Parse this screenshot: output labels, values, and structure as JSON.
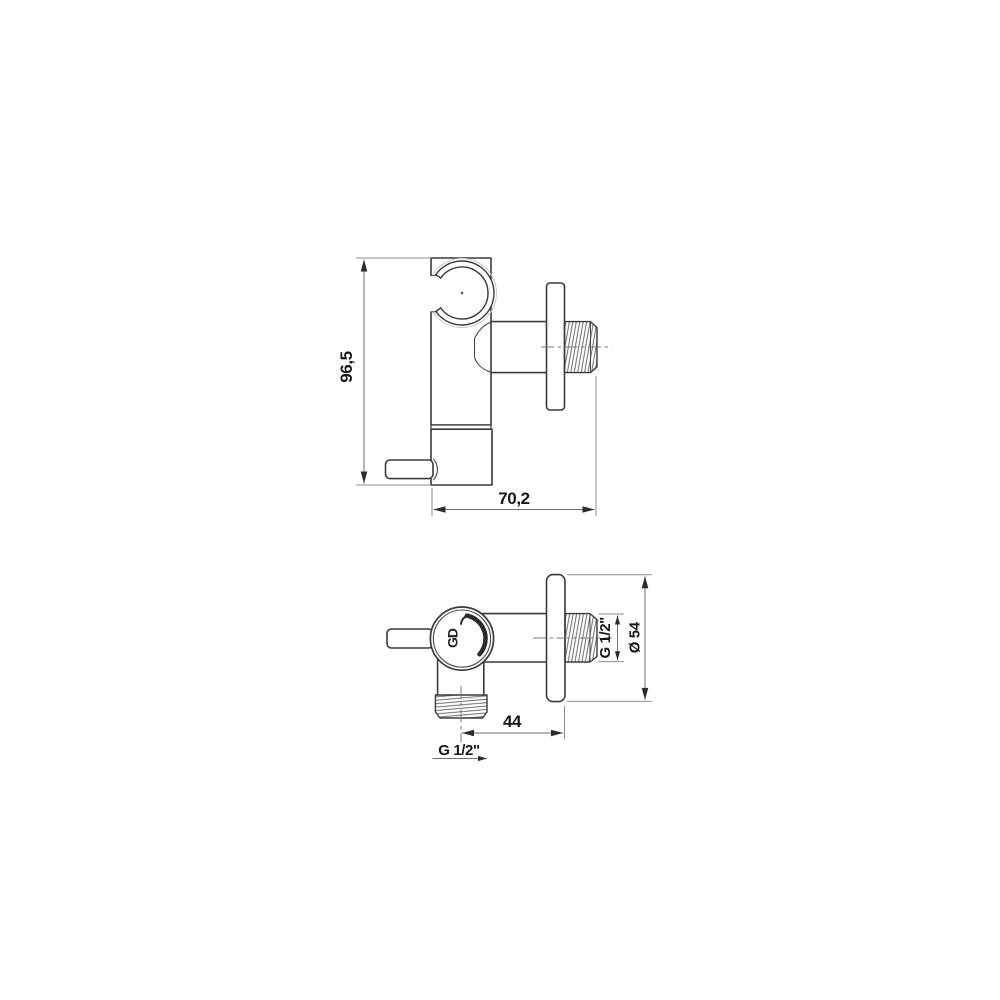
{
  "drawing": {
    "description": "Two-view dimensioned technical drawing of a wall-mounted angle valve with shower-holder clip",
    "side_view": {
      "height": "96,5",
      "width": "70,2"
    },
    "plan_view": {
      "offset": "44",
      "outlet_thread": "G 1/2\"",
      "inlet_thread": "G 1/2\"",
      "flange_diameter": "Ø 54",
      "logo": "GD"
    },
    "colors": {
      "background": "#ffffff",
      "outline": "#3a3a3a",
      "dimension_line": "#6e6e6e",
      "text": "#161616"
    }
  }
}
